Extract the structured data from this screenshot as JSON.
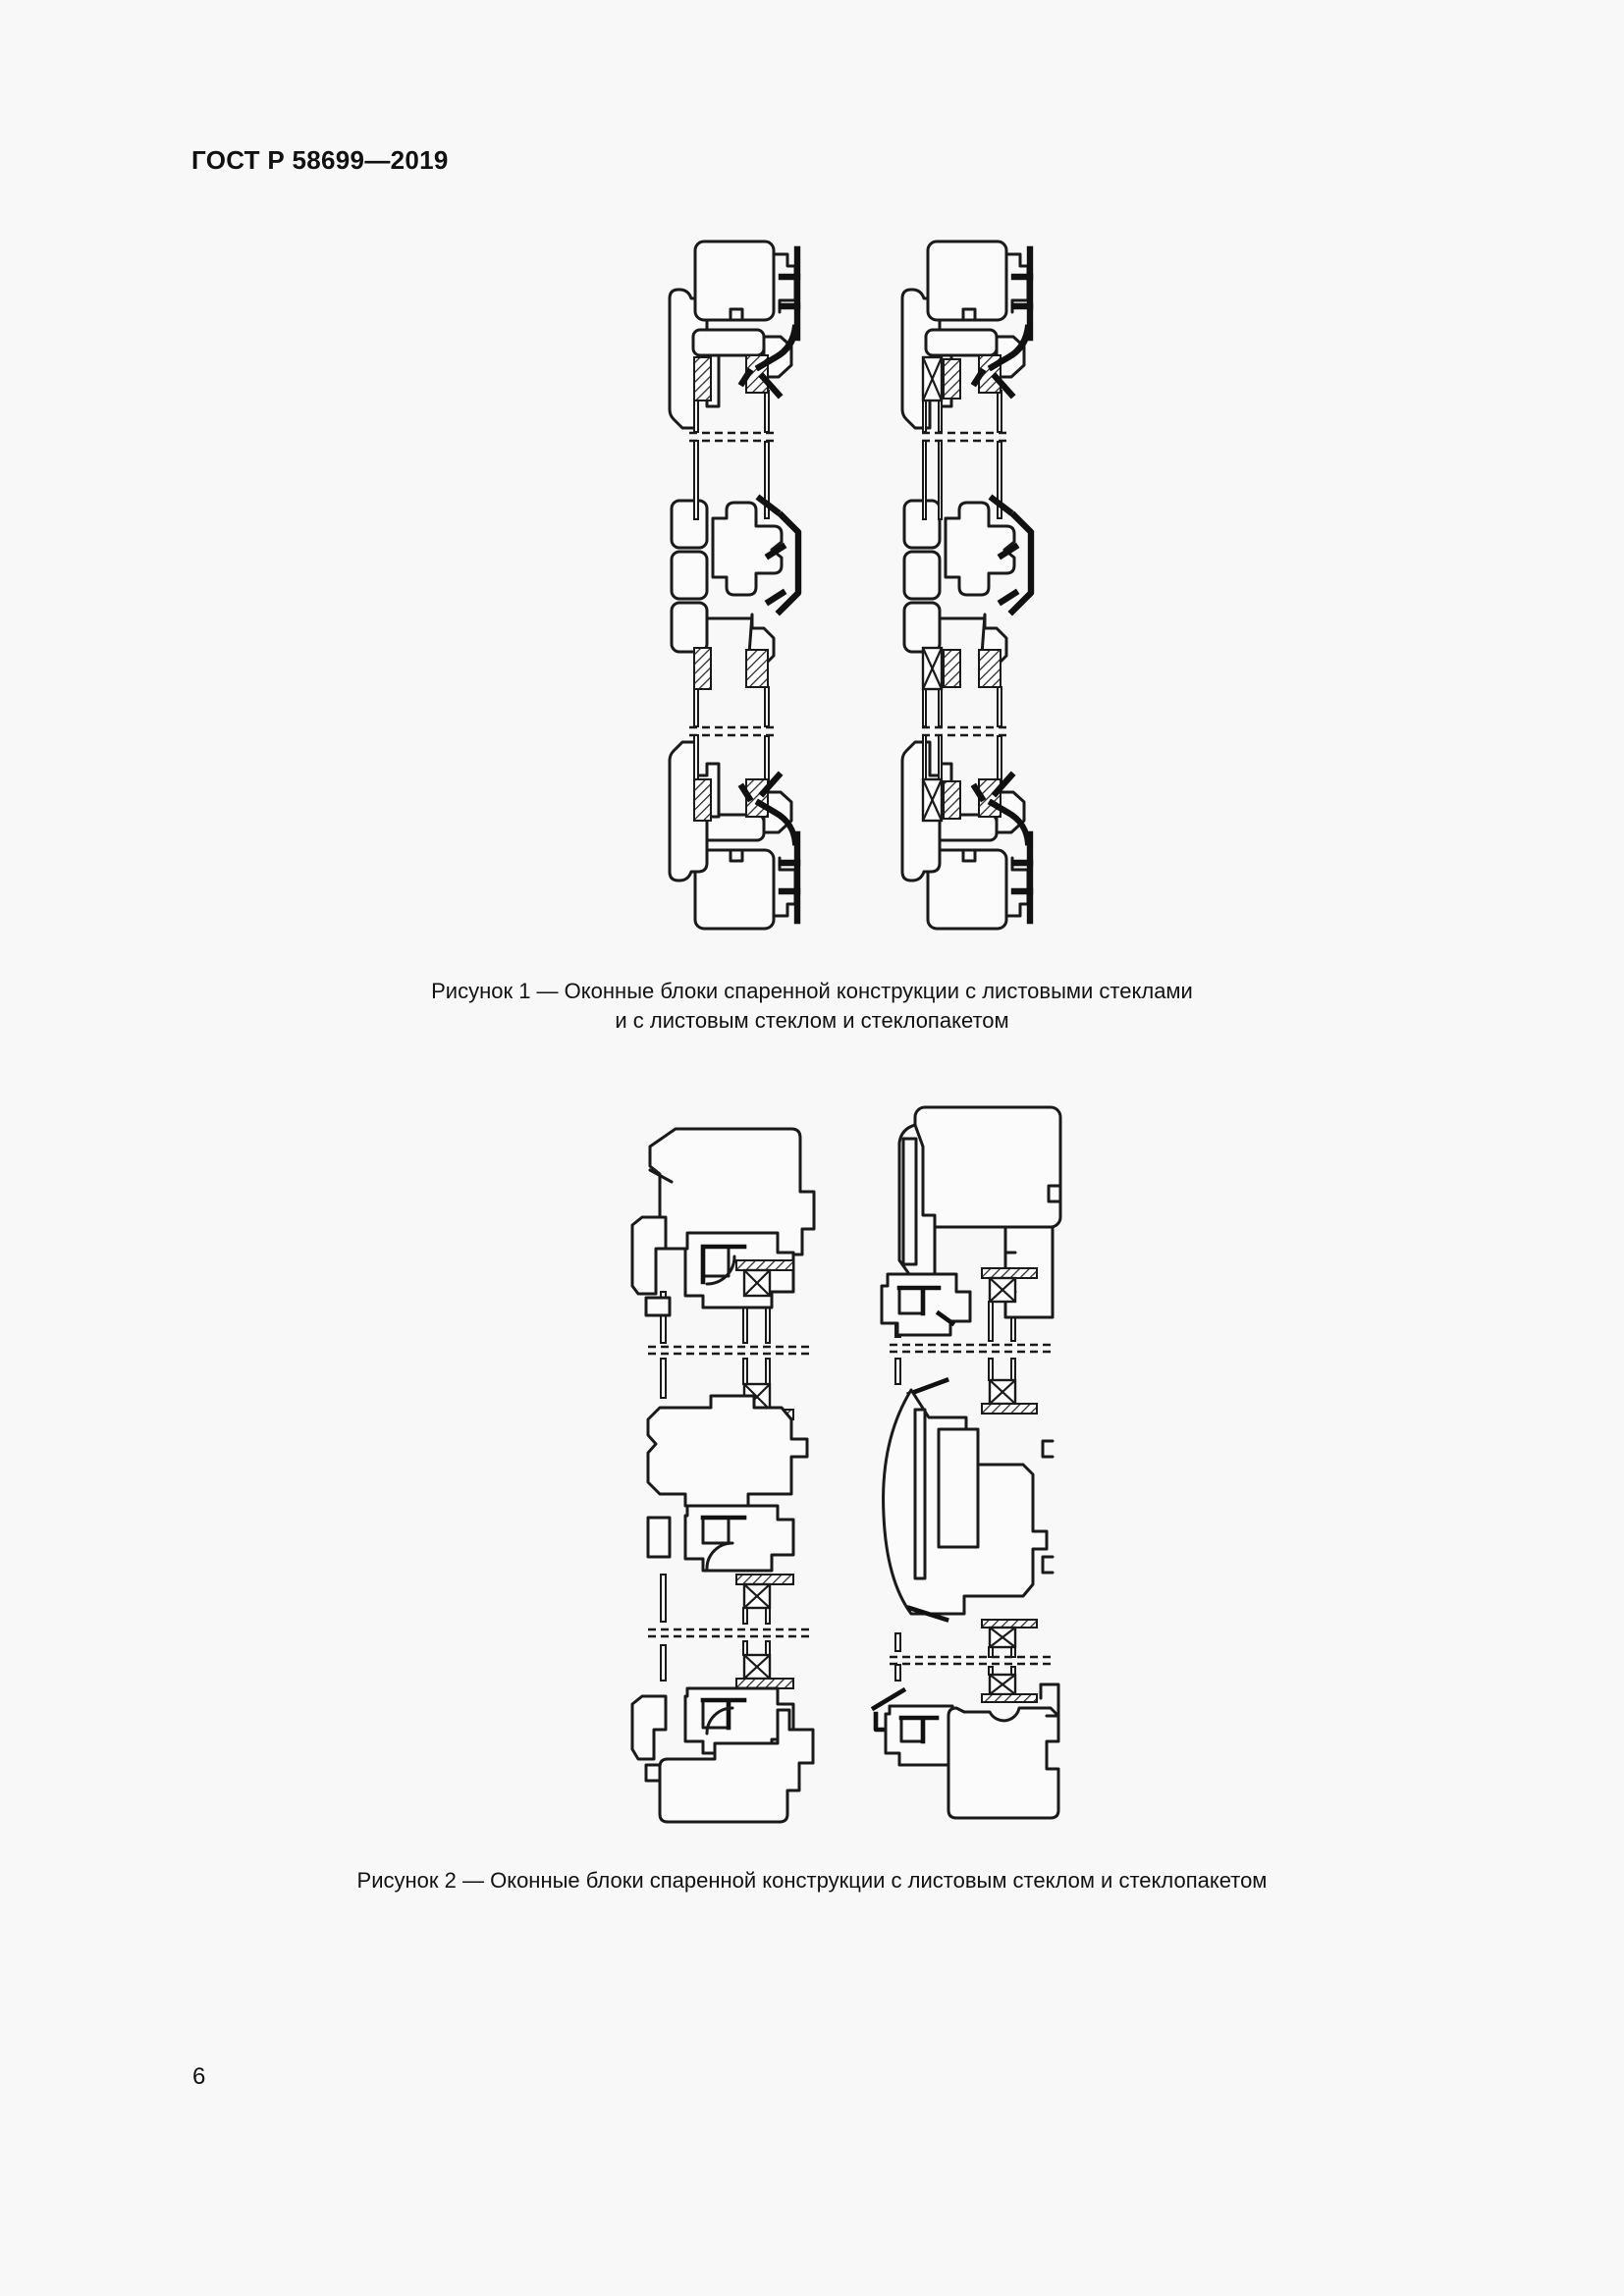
{
  "document": {
    "standard_code": "ГОСТ Р 58699—2019",
    "page_number": "6"
  },
  "figures": {
    "figure1": {
      "name": "Рисунок 1",
      "caption_line1": "Рисунок 1 — Оконные блоки спаренной конструкции с листовыми стеклами",
      "caption_line2": "и с листовым стеклом и стеклопакетом",
      "content": "Два вертикальных разреза оконных блоков спаренной конструкции: слева — с листовыми стеклами, справа — с листовым стеклом и стеклопакетом"
    },
    "figure2": {
      "name": "Рисунок 2",
      "caption": "Рисунок 2 — Оконные блоки спаренной конструкции с листовым стеклом и стеклопакетом"
    }
  },
  "drawing_colors": {
    "line": "#1a1a1a",
    "paper": "#f8f8f8"
  }
}
